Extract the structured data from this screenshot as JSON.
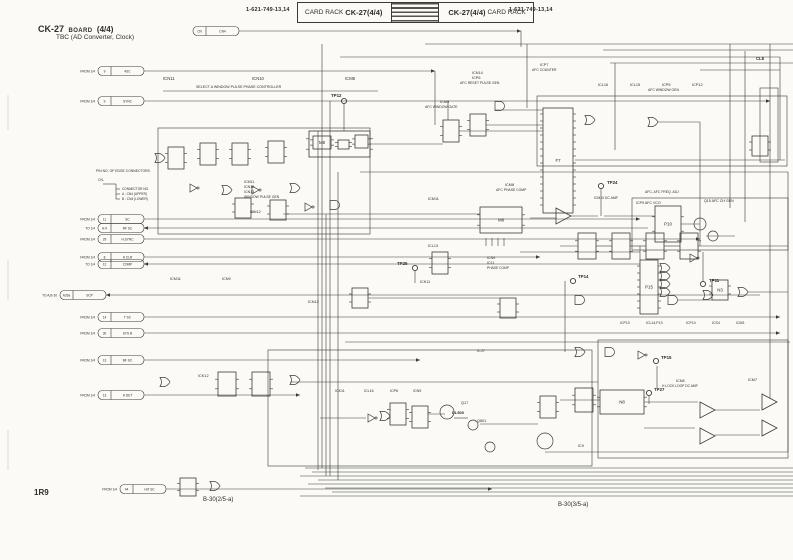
{
  "header": {
    "pn_left": "1-621-749-13,14",
    "rack_left": "CARD RACK",
    "model_left": "CK-27(4/4)",
    "model_right": "CK-27(4/4)",
    "rack_right": "CARD RACK",
    "pn_right": "1-621-749-13,14"
  },
  "title": {
    "model": "CK-27",
    "word": "BOARD",
    "num": "(4/4)",
    "subtitle": "TBC (AD Converter, Clock)"
  },
  "footer": {
    "ref": "1R9",
    "sheet_left": "B-30(2/5-a)",
    "sheet_right": "B-30(3/5-a)"
  },
  "schematic": {
    "ink": "#3a3a38",
    "stubs": [
      {
        "y": 31,
        "x": 193,
        "tag": "",
        "pin": "CN",
        "sig": "CN4",
        "to": 521
      },
      {
        "y": 71,
        "x": 98,
        "tag": "FROM 1/4",
        "pin": "9",
        "sig": "4SC",
        "to": 435
      },
      {
        "y": 101,
        "x": 98,
        "tag": "FROM 1/4",
        "pin": "9",
        "sig": "SYNC",
        "to": 770
      },
      {
        "y": 219,
        "x": 98,
        "tag": "FROM 1/4",
        "pin": "11",
        "sig": "SC",
        "to": 640
      },
      {
        "y": 228,
        "x": 98,
        "tag": "TO 1/4",
        "pin": "A-9",
        "sig": "RF SC",
        "to": 648,
        "dir": "left"
      },
      {
        "y": 239,
        "x": 98,
        "tag": "FROM 1/4",
        "pin": "29",
        "sig": "H.SYNC",
        "to": 700
      },
      {
        "y": 257,
        "x": 98,
        "tag": "FROM 1/4",
        "pin": "8",
        "sig": "H CLR",
        "to": 540
      },
      {
        "y": 264,
        "x": 98,
        "tag": "TO 1/4",
        "pin": "12",
        "sig": "COMP",
        "to": 640,
        "dir": "left"
      },
      {
        "y": 295,
        "x": 60,
        "tag": "TO A,B-30",
        "pin": "A29a",
        "sig": "SCP",
        "to": 760,
        "dir": "left"
      },
      {
        "y": 317,
        "x": 98,
        "tag": "FROM 1/4",
        "pin": "14",
        "sig": "T SC",
        "to": 780
      },
      {
        "y": 333,
        "x": 98,
        "tag": "FROM 1/4",
        "pin": "30",
        "sig": "SYS B",
        "to": 780
      },
      {
        "y": 360,
        "x": 98,
        "tag": "FROM 1/4",
        "pin": "13",
        "sig": "BF SC",
        "to": 420
      },
      {
        "y": 395,
        "x": 98,
        "tag": "FROM 1/4",
        "pin": "13",
        "sig": "H DET",
        "to": 300
      },
      {
        "y": 489,
        "x": 120,
        "tag": "FROM 1/4",
        "pin": "44",
        "sig": "H/2 SC",
        "to": 492
      }
    ],
    "hwires": [
      [
        425,
        44,
        793
      ],
      [
        603,
        50,
        793
      ],
      [
        340,
        57,
        780
      ],
      [
        610,
        63,
        793
      ],
      [
        700,
        70,
        780
      ],
      [
        163,
        91,
        378
      ],
      [
        360,
        172,
        788
      ],
      [
        575,
        160,
        785
      ],
      [
        283,
        214,
        480
      ],
      [
        530,
        218,
        556
      ],
      [
        571,
        216,
        598
      ],
      [
        604,
        216,
        655
      ],
      [
        681,
        224,
        700
      ],
      [
        706,
        236,
        735
      ],
      [
        520,
        252,
        640
      ],
      [
        560,
        246,
        578
      ],
      [
        596,
        246,
        612
      ],
      [
        630,
        246,
        646
      ],
      [
        664,
        246,
        680
      ],
      [
        698,
        246,
        788
      ],
      [
        678,
        300,
        712
      ],
      [
        748,
        292,
        788
      ],
      [
        290,
        382,
        598
      ],
      [
        320,
        418,
        366
      ],
      [
        428,
        414,
        445
      ],
      [
        454,
        418,
        468
      ],
      [
        480,
        424,
        538
      ],
      [
        560,
        400,
        600
      ],
      [
        644,
        402,
        698
      ],
      [
        715,
        410,
        760
      ],
      [
        715,
        435,
        760
      ],
      [
        644,
        428,
        695
      ],
      [
        345,
        342,
        790
      ],
      [
        368,
        298,
        500
      ],
      [
        370,
        144,
        443
      ],
      [
        495,
        110,
        543
      ],
      [
        459,
        131,
        543
      ],
      [
        486,
        125,
        543
      ],
      [
        658,
        122,
        700
      ],
      [
        305,
        468,
        793
      ],
      [
        312,
        472,
        793
      ],
      [
        300,
        476,
        793
      ],
      [
        318,
        480,
        793
      ],
      [
        308,
        484,
        793
      ],
      [
        325,
        488,
        793
      ],
      [
        332,
        492,
        793
      ],
      [
        300,
        496,
        793
      ],
      [
        545,
        452,
        788
      ],
      [
        103,
        184,
        116
      ],
      [
        116,
        189,
        120
      ],
      [
        116,
        194,
        120
      ],
      [
        116,
        199,
        120
      ]
    ],
    "vwires": [
      [
        521,
        31,
        47
      ],
      [
        322,
        44,
        468
      ],
      [
        330,
        101,
        476
      ],
      [
        338,
        172,
        480
      ],
      [
        344,
        104,
        131
      ],
      [
        435,
        71,
        125
      ],
      [
        448,
        101,
        120
      ],
      [
        527,
        44,
        108
      ],
      [
        615,
        63,
        150
      ],
      [
        700,
        122,
        246
      ],
      [
        730,
        44,
        208
      ],
      [
        745,
        51,
        222
      ],
      [
        770,
        44,
        398
      ],
      [
        780,
        57,
        160
      ],
      [
        703,
        252,
        281
      ],
      [
        657,
        366,
        388
      ],
      [
        565,
        281,
        352
      ],
      [
        640,
        246,
        260
      ],
      [
        788,
        172,
        452
      ],
      [
        318,
        131,
        470
      ],
      [
        326,
        214,
        476
      ],
      [
        415,
        271,
        283
      ],
      [
        649,
        396,
        404
      ],
      [
        601,
        189,
        216
      ],
      [
        486,
        238,
        246
      ],
      [
        492,
        238,
        246
      ],
      [
        498,
        238,
        246
      ],
      [
        504,
        238,
        246
      ],
      [
        116,
        184,
        199
      ]
    ],
    "marks": [
      [
        8,
        95,
        130
      ],
      [
        8,
        260,
        300
      ],
      [
        8,
        430,
        470
      ]
    ],
    "rects": [
      [
        537,
        96,
        250,
        70
      ],
      [
        268,
        350,
        324,
        116
      ],
      [
        598,
        340,
        190,
        118
      ],
      [
        632,
        198,
        156,
        52
      ],
      [
        158,
        128,
        212,
        106
      ],
      [
        760,
        88,
        18,
        74
      ]
    ],
    "blocks": [
      [
        168,
        147,
        16,
        22,
        ""
      ],
      [
        200,
        143,
        16,
        22,
        ""
      ],
      [
        232,
        143,
        16,
        22,
        ""
      ],
      [
        268,
        141,
        16,
        22,
        ""
      ],
      [
        309,
        131,
        61,
        26,
        ""
      ],
      [
        313,
        136,
        18,
        13,
        "M8"
      ],
      [
        338,
        140,
        11,
        9,
        ""
      ],
      [
        355,
        135,
        13,
        13,
        ""
      ],
      [
        235,
        198,
        16,
        20,
        ""
      ],
      [
        270,
        200,
        16,
        20,
        ""
      ],
      [
        443,
        120,
        16,
        22,
        ""
      ],
      [
        470,
        114,
        16,
        22,
        ""
      ],
      [
        543,
        108,
        30,
        105,
        "F7"
      ],
      [
        578,
        233,
        18,
        26,
        ""
      ],
      [
        612,
        233,
        18,
        26,
        ""
      ],
      [
        646,
        233,
        18,
        26,
        ""
      ],
      [
        680,
        233,
        18,
        26,
        ""
      ],
      [
        480,
        207,
        42,
        26,
        "M8"
      ],
      [
        655,
        206,
        26,
        36,
        "P10"
      ],
      [
        640,
        260,
        18,
        54,
        "P15"
      ],
      [
        712,
        280,
        16,
        20,
        "N3"
      ],
      [
        218,
        372,
        18,
        24,
        ""
      ],
      [
        252,
        372,
        18,
        24,
        ""
      ],
      [
        390,
        403,
        16,
        22,
        ""
      ],
      [
        412,
        406,
        16,
        22,
        ""
      ],
      [
        540,
        396,
        16,
        22,
        ""
      ],
      [
        575,
        388,
        18,
        24,
        ""
      ],
      [
        600,
        390,
        44,
        24,
        "N8"
      ],
      [
        180,
        478,
        16,
        18,
        ""
      ],
      [
        352,
        288,
        16,
        20,
        ""
      ],
      [
        432,
        252,
        16,
        22,
        ""
      ],
      [
        500,
        298,
        16,
        20,
        ""
      ],
      [
        752,
        136,
        16,
        20,
        ""
      ]
    ],
    "gates": [
      [
        155,
        158,
        "or"
      ],
      [
        190,
        188,
        "inv"
      ],
      [
        222,
        190,
        "or"
      ],
      [
        252,
        190,
        "inv"
      ],
      [
        290,
        188,
        "or"
      ],
      [
        305,
        207,
        "inv"
      ],
      [
        330,
        205,
        "and"
      ],
      [
        495,
        106,
        "and"
      ],
      [
        585,
        120,
        "or"
      ],
      [
        648,
        122,
        "or"
      ],
      [
        660,
        268,
        "or"
      ],
      [
        660,
        276,
        "or"
      ],
      [
        660,
        284,
        "or"
      ],
      [
        660,
        292,
        "or"
      ],
      [
        668,
        300,
        "and"
      ],
      [
        690,
        258,
        "inv"
      ],
      [
        738,
        292,
        "or"
      ],
      [
        703,
        295,
        "or"
      ],
      [
        575,
        300,
        "and"
      ],
      [
        160,
        382,
        "or"
      ],
      [
        290,
        380,
        "or"
      ],
      [
        368,
        418,
        "inv"
      ],
      [
        380,
        416,
        "or"
      ],
      [
        575,
        352,
        "or"
      ],
      [
        605,
        352,
        "and"
      ],
      [
        638,
        355,
        "inv"
      ],
      [
        210,
        486,
        "or"
      ]
    ],
    "opamps": [
      [
        556,
        216
      ],
      [
        700,
        410
      ],
      [
        700,
        436
      ],
      [
        762,
        402
      ],
      [
        762,
        428
      ]
    ],
    "transistors": [
      [
        700,
        224,
        6
      ],
      [
        713,
        236,
        5
      ],
      [
        447,
        412,
        7
      ],
      [
        473,
        425,
        5
      ],
      [
        545,
        441,
        8
      ],
      [
        490,
        447,
        5
      ]
    ],
    "testpoints": [
      {
        "x": 344,
        "y": 101,
        "t": "TP12",
        "lx": 331,
        "ly": 97
      },
      {
        "x": 415,
        "y": 268,
        "t": "TP25",
        "lx": 397,
        "ly": 265
      },
      {
        "x": 601,
        "y": 186,
        "t": "TP24",
        "lx": 607,
        "ly": 184
      },
      {
        "x": 703,
        "y": 284,
        "t": "TP11",
        "lx": 709,
        "ly": 282
      },
      {
        "x": 573,
        "y": 281,
        "t": "TP14",
        "lx": 578,
        "ly": 278
      },
      {
        "x": 656,
        "y": 361,
        "t": "TP15",
        "lx": 661,
        "ly": 359
      },
      {
        "x": 649,
        "y": 393,
        "t": "TP27",
        "lx": 654,
        "ly": 391
      }
    ],
    "labels": [
      {
        "t": "ICN11",
        "x": 163,
        "y": 80,
        "s": 4.2
      },
      {
        "t": "ICN10",
        "x": 252,
        "y": 80,
        "s": 4.2
      },
      {
        "t": "ICM8",
        "x": 345,
        "y": 80,
        "s": 4.2
      },
      {
        "t": "SELECT A WINDOW PULSE PHASE CONTROLLER",
        "x": 196,
        "y": 88,
        "s": 3.6
      },
      {
        "t": "ICN14",
        "x": 472,
        "y": 74,
        "s": 3.8
      },
      {
        "t": "ICP6",
        "x": 472,
        "y": 79,
        "s": 3.8
      },
      {
        "t": "AFC RESET PULSE GEN",
        "x": 460,
        "y": 84,
        "s": 3.4
      },
      {
        "t": "ICP7",
        "x": 540,
        "y": 66,
        "s": 3.8
      },
      {
        "t": "AFC COUNTER",
        "x": 532,
        "y": 71,
        "s": 3.4
      },
      {
        "t": "ICM9",
        "x": 440,
        "y": 103,
        "s": 3.8
      },
      {
        "t": "AFC WINDOW GATE",
        "x": 425,
        "y": 108,
        "s": 3.4
      },
      {
        "t": "ICL16",
        "x": 598,
        "y": 86,
        "s": 3.8
      },
      {
        "t": "ICL15",
        "x": 630,
        "y": 86,
        "s": 3.8
      },
      {
        "t": "ICP5",
        "x": 662,
        "y": 86,
        "s": 3.8
      },
      {
        "t": "ICP12",
        "x": 692,
        "y": 86,
        "s": 3.8
      },
      {
        "t": "AFC WINDOW GEN",
        "x": 648,
        "y": 91,
        "s": 3.4
      },
      {
        "t": "CL8",
        "x": 756,
        "y": 60,
        "s": 4.2,
        "b": 1
      },
      {
        "t": "ICM8",
        "x": 505,
        "y": 186,
        "s": 3.8
      },
      {
        "t": "AFC PHASE COMP",
        "x": 496,
        "y": 191,
        "s": 3.4
      },
      {
        "t": "ICM10  DC AMP",
        "x": 594,
        "y": 199,
        "s": 3.4
      },
      {
        "t": "AFC, AFC FREQ. ADJ",
        "x": 645,
        "y": 193,
        "s": 3.4
      },
      {
        "t": "ICP9  AFC VCO",
        "x": 636,
        "y": 204,
        "s": 3.6
      },
      {
        "t": "Q15  AFC CH GEN",
        "x": 704,
        "y": 202,
        "s": 3.6
      },
      {
        "t": "ICM11",
        "x": 428,
        "y": 200,
        "s": 3.8
      },
      {
        "t": "ICL13",
        "x": 428,
        "y": 247,
        "s": 3.8
      },
      {
        "t": "ICK11",
        "x": 420,
        "y": 283,
        "s": 3.8
      },
      {
        "t": "ICN9",
        "x": 487,
        "y": 259,
        "s": 3.6
      },
      {
        "t": "IC11",
        "x": 487,
        "y": 264,
        "s": 3.6
      },
      {
        "t": "PHASE COMP",
        "x": 487,
        "y": 269,
        "s": 3.3
      },
      {
        "t": "ICM11",
        "x": 244,
        "y": 183,
        "s": 3.6
      },
      {
        "t": "ICN10",
        "x": 244,
        "y": 188,
        "s": 3.6
      },
      {
        "t": "ICN13",
        "x": 244,
        "y": 193,
        "s": 3.6
      },
      {
        "t": "WINDOW PULSE GEN",
        "x": 244,
        "y": 198,
        "s": 3.4
      },
      {
        "t": "ICN12",
        "x": 250,
        "y": 213,
        "s": 3.8
      },
      {
        "t": "ICM11",
        "x": 170,
        "y": 280,
        "s": 3.8
      },
      {
        "t": "ICN9",
        "x": 222,
        "y": 280,
        "s": 3.8
      },
      {
        "t": "ICN12",
        "x": 308,
        "y": 303,
        "s": 3.8
      },
      {
        "t": "ICK12",
        "x": 198,
        "y": 377,
        "s": 3.8
      },
      {
        "t": "ICK11",
        "x": 335,
        "y": 392,
        "s": 3.6
      },
      {
        "t": "ICL16",
        "x": 364,
        "y": 392,
        "s": 3.6
      },
      {
        "t": "ICP6",
        "x": 390,
        "y": 392,
        "s": 3.6
      },
      {
        "t": "ICN9",
        "x": 413,
        "y": 392,
        "s": 3.6
      },
      {
        "t": "Q17",
        "x": 461,
        "y": 404,
        "s": 3.8
      },
      {
        "t": "DL500",
        "x": 452,
        "y": 414,
        "s": 4,
        "b": 1
      },
      {
        "t": "Q801",
        "x": 477,
        "y": 422,
        "s": 3.8
      },
      {
        "t": "ICJ7",
        "x": 477,
        "y": 352,
        "s": 3.8
      },
      {
        "t": "ICN8",
        "x": 676,
        "y": 382,
        "s": 3.8
      },
      {
        "t": "H LOCK LOOP DC AMP",
        "x": 662,
        "y": 387,
        "s": 3.3
      },
      {
        "t": "ICM7",
        "x": 748,
        "y": 381,
        "s": 3.8
      },
      {
        "t": "IC9",
        "x": 578,
        "y": 447,
        "s": 3.8
      },
      {
        "t": "ICP13",
        "x": 620,
        "y": 324,
        "s": 3.5
      },
      {
        "t": "ICL14,P13",
        "x": 646,
        "y": 324,
        "s": 3.5
      },
      {
        "t": "ICP14",
        "x": 686,
        "y": 324,
        "s": 3.5
      },
      {
        "t": "ICS4",
        "x": 712,
        "y": 324,
        "s": 3.5
      },
      {
        "t": "ICM3",
        "x": 736,
        "y": 324,
        "s": 3.5
      },
      {
        "t": "PIN NO. OF EDGE CONNECTORS",
        "x": 96,
        "y": 172,
        "s": 3.4
      },
      {
        "t": "CN-",
        "x": 98,
        "y": 181,
        "s": 3.4
      },
      {
        "t": "CONNECTOR NO.",
        "x": 122,
        "y": 190,
        "s": 3.2
      },
      {
        "t": "A : CN4 (UPPER)",
        "x": 122,
        "y": 195,
        "s": 3.2
      },
      {
        "t": "B : CN4 (LOWER)",
        "x": 122,
        "y": 200,
        "s": 3.2
      }
    ]
  }
}
